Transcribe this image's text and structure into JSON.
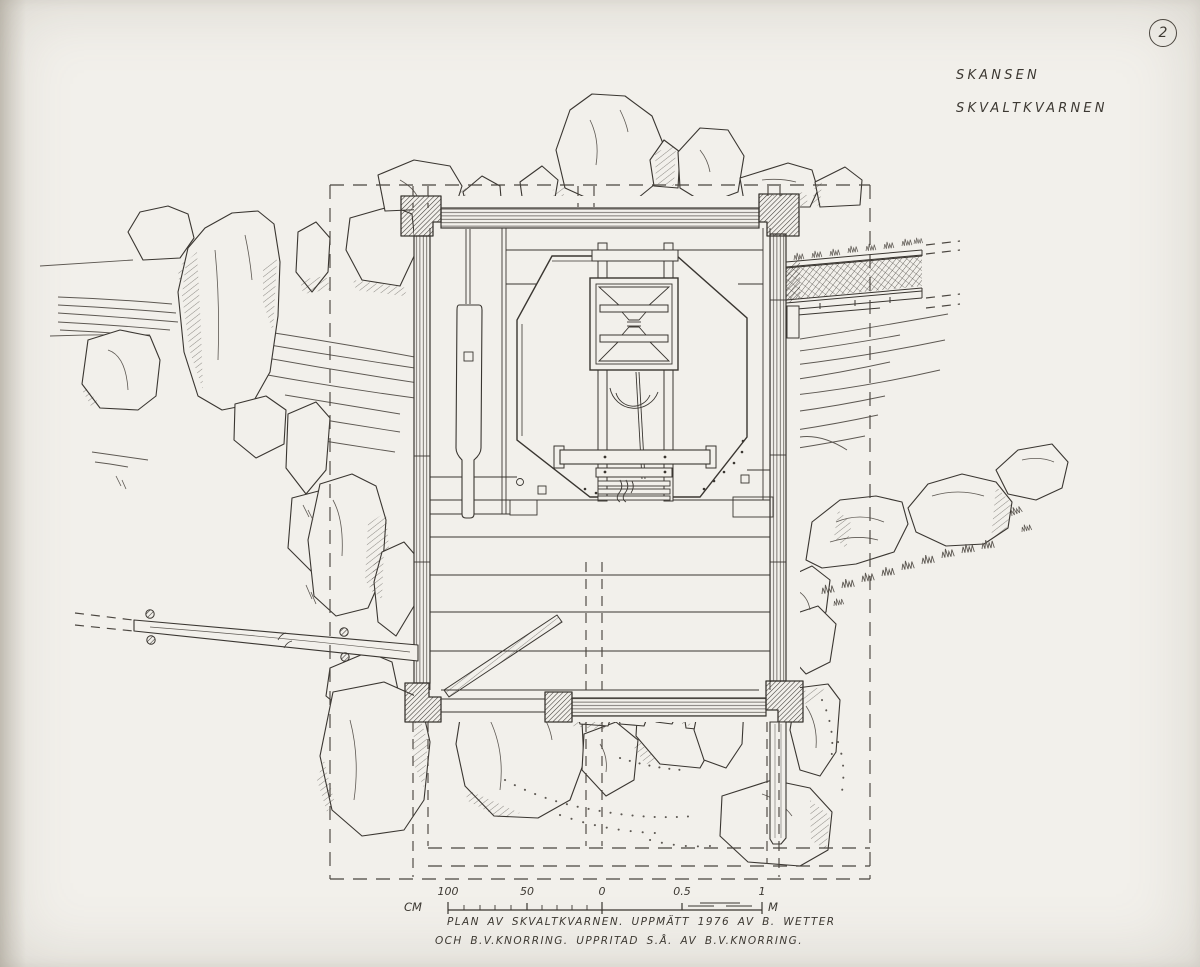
{
  "sheet": {
    "number": "2",
    "site_label": "SKANSEN",
    "subject_label": "SKVALTKVARNEN",
    "caption_line1": "PLAN AV SKVALTKVARNEN. UPPMÄTT 1976 AV B. WETTER",
    "caption_line2": "OCH B.V.KNORRING. UPPRITAD S.Å. AV B.V.KNORRING.",
    "scale_bar": {
      "unit_left": "CM",
      "unit_right": "M",
      "ticks": [
        "100",
        "50",
        "0",
        "0.5",
        "1"
      ]
    },
    "colors": {
      "paper": "#f2f0eb",
      "ink": "#3a3631",
      "ink_light": "#5d5852",
      "dash": "#4a453f"
    }
  }
}
